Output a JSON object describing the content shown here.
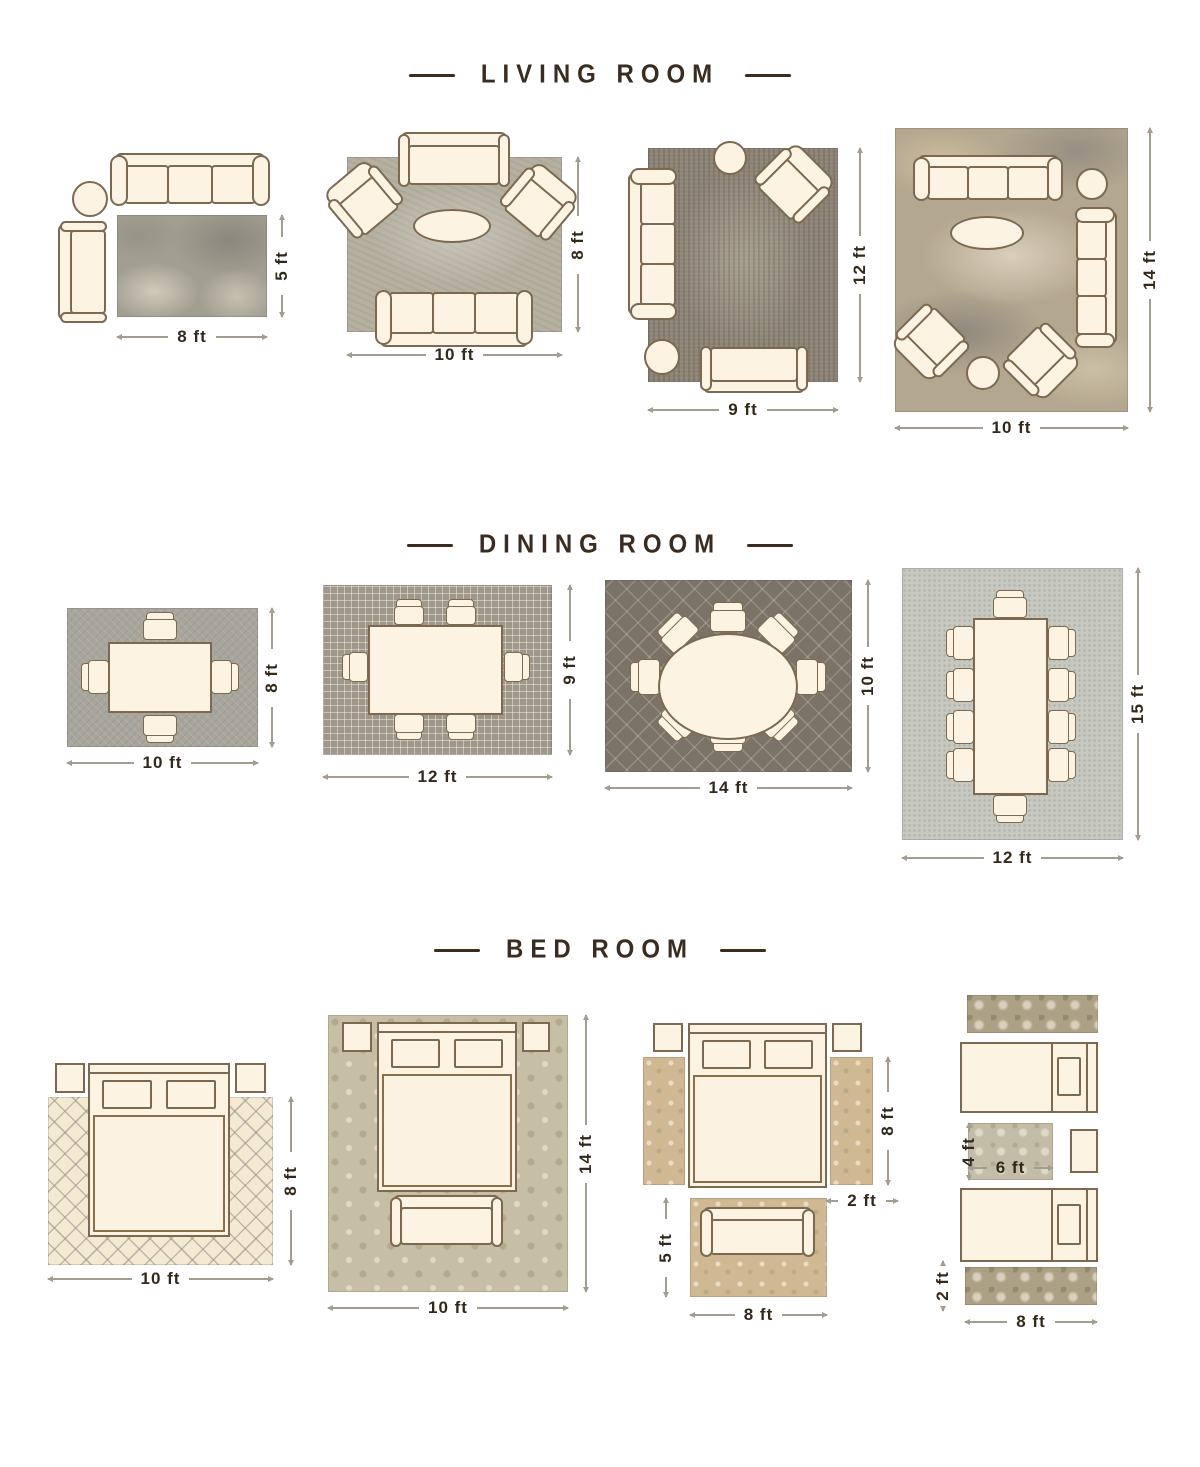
{
  "colors": {
    "background": "#ffffff",
    "title_text": "#3a2c1e",
    "dimension_label": "#33291a",
    "dimension_line": "#a49c8e",
    "furniture_fill": "#fcf3e3",
    "furniture_outline": "#7c6950"
  },
  "icons": {
    "sofa-icon": "css-shape",
    "armchair-icon": "css-shape",
    "coffee-table-icon": "css-ellipse",
    "side-table-icon": "css-circle",
    "dining-table-icon": "css-rect",
    "dining-chair-icon": "css-shape",
    "bed-icon": "css-shape",
    "nightstand-icon": "css-rect",
    "bench-icon": "css-shape",
    "runner-rug": "css-rect"
  },
  "sections": [
    {
      "title": "LIVING ROOM",
      "layouts": [
        {
          "labels": {
            "w": "8 ft",
            "h": "5 ft"
          }
        },
        {
          "labels": {
            "w": "10 ft",
            "h": "8 ft"
          }
        },
        {
          "labels": {
            "w": "9 ft",
            "h": "12 ft"
          }
        },
        {
          "labels": {
            "w": "10 ft",
            "h": "14 ft"
          }
        }
      ]
    },
    {
      "title": "DINING ROOM",
      "layouts": [
        {
          "labels": {
            "w": "10 ft",
            "h": "8 ft"
          }
        },
        {
          "labels": {
            "w": "12 ft",
            "h": "9 ft"
          }
        },
        {
          "labels": {
            "w": "14 ft",
            "h": "10 ft"
          }
        },
        {
          "labels": {
            "w": "12 ft",
            "h": "15 ft"
          }
        }
      ]
    },
    {
      "title": "BED ROOM",
      "layouts": [
        {
          "labels": {
            "w": "10 ft",
            "h": "8 ft"
          }
        },
        {
          "labels": {
            "w": "10 ft",
            "h": "14 ft"
          }
        },
        {
          "labels": {
            "w": "8 ft",
            "runner_h": "8 ft",
            "runner_w": "2 ft",
            "seat_rug_h": "5 ft"
          }
        },
        {
          "labels": {
            "w": "8 ft",
            "mid_w": "6 ft",
            "mid_h": "4 ft",
            "runner_h": "2 ft"
          }
        }
      ]
    }
  ]
}
